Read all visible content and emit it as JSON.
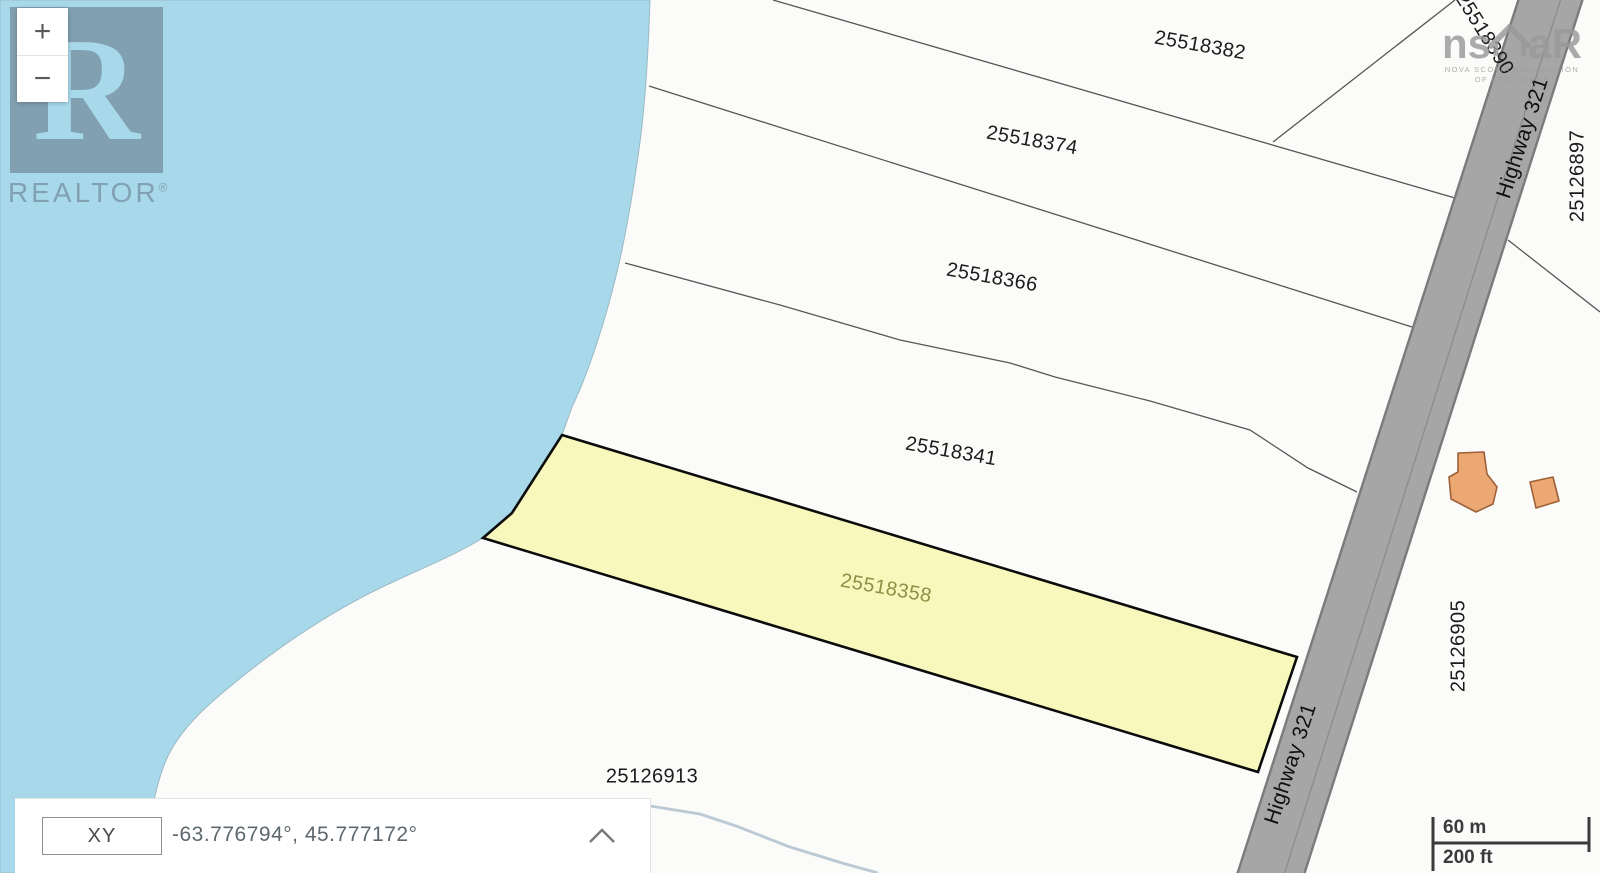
{
  "controls": {
    "zoom_in_label": "+",
    "zoom_out_label": "−"
  },
  "watermarks": {
    "realtor_logo_letter": "R",
    "realtor_text": "REALTOR",
    "registered_symbol": "®",
    "nsar_left": "ns",
    "nsar_right": "aR",
    "nsar_tagline_line1": "NOVA SCOTIA ASSOCIATION",
    "nsar_tagline_line2": "OF REALTORS®"
  },
  "parcels": [
    {
      "label": "25518382",
      "highlighted": false
    },
    {
      "label": "25518374",
      "highlighted": false
    },
    {
      "label": "25518366",
      "highlighted": false
    },
    {
      "label": "25518341",
      "highlighted": false
    },
    {
      "label": "25518358",
      "highlighted": true
    },
    {
      "label": "25126913",
      "highlighted": false
    },
    {
      "label": "25126905",
      "highlighted": false
    },
    {
      "label": "25126897",
      "highlighted": false
    },
    {
      "label": "25518390",
      "highlighted": false
    }
  ],
  "road": {
    "label": "Highway 321"
  },
  "coordinate_bar": {
    "mode_label": "XY",
    "coordinates": "-63.776794°, 45.777172°"
  },
  "scale_bar": {
    "metric_label": "60 m",
    "imperial_label": "200 ft"
  },
  "colors": {
    "water": "#a8d9ea",
    "highlight_fill": "#f8f7bc",
    "highlight_label": "#8e9045",
    "road": "#a7a6a6",
    "building": "#eba873"
  }
}
